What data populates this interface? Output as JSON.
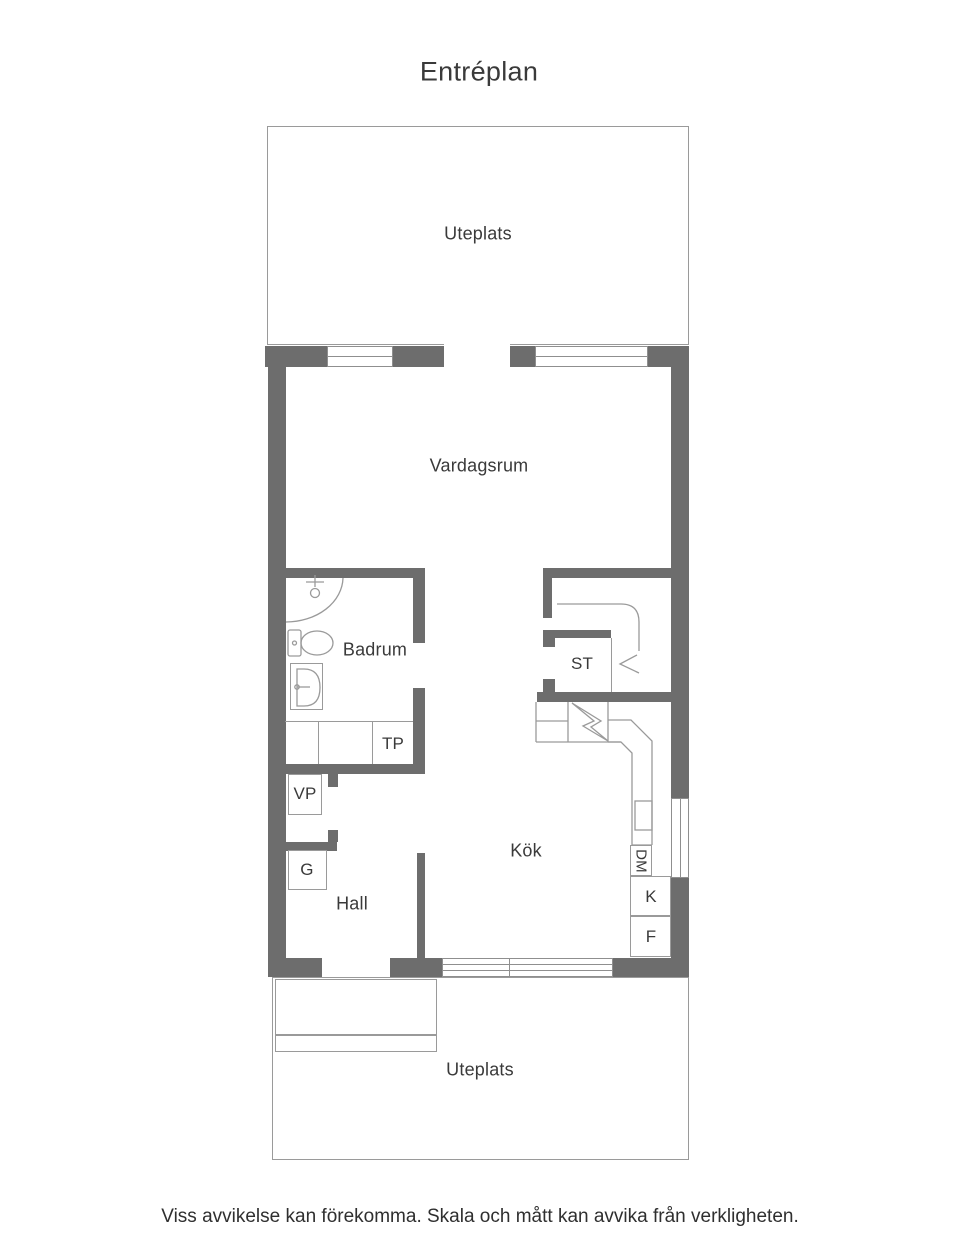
{
  "title": "Entréplan",
  "rooms": {
    "uteplats_top": "Uteplats",
    "vardagsrum": "Vardagsrum",
    "badrum": "Badrum",
    "st": "ST",
    "tp": "TP",
    "vp": "VP",
    "g": "G",
    "hall": "Hall",
    "kok": "Kök",
    "dm": "DM",
    "k": "K",
    "f": "F",
    "uteplats_bottom": "Uteplats"
  },
  "footer": "Viss avvikelse kan förekomma. Skala och mått kan avvika från verkligheten.",
  "colors": {
    "wall": "#6d6d6d",
    "line": "#9a9a9a",
    "window_frame": "#8f8f8f",
    "text": "#3a3a3a"
  }
}
